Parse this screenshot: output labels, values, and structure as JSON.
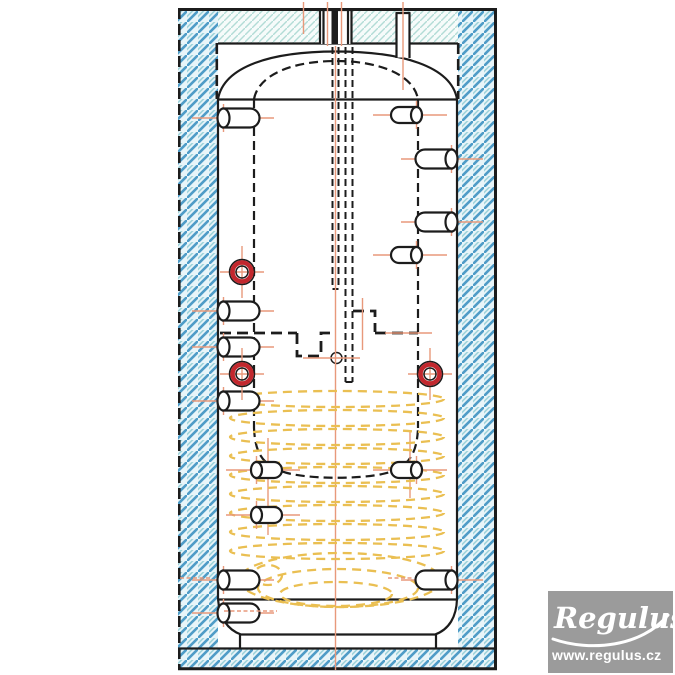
{
  "logo": {
    "brand": "Regulus",
    "url": "www.regulus.cz"
  },
  "colors": {
    "ink": "#1c1c1c",
    "centerline_orange": "#e8997b",
    "coil_yellow": "#eabf52",
    "marker_red": "#c2272d",
    "hatch_bg": "#e8f5f9",
    "hatch_stripe": "#4f9cc7",
    "hatch_stripe_light": "#9fd3da",
    "hatch_fine_bg": "#f6fbfa",
    "hatch_fine_stripe": "#b2dcd6",
    "logo_bg": "#9b9b9b",
    "logo_text": "#ffffff"
  },
  "drawing": {
    "ports": [
      {
        "id": "top-left",
        "side": "left",
        "x": 218,
        "y": 118
      },
      {
        "id": "left-upper",
        "side": "left",
        "x": 218,
        "y": 311
      },
      {
        "id": "left-middle",
        "side": "left",
        "x": 218,
        "y": 347
      },
      {
        "id": "left-lower",
        "side": "left",
        "x": 218,
        "y": 401
      },
      {
        "id": "left-bottom",
        "side": "left",
        "x": 218,
        "y": 580
      },
      {
        "id": "left-drain",
        "side": "left",
        "x": 218,
        "y": 613
      },
      {
        "id": "coil-left-upper",
        "side": "inner-left",
        "x": 252,
        "y": 470
      },
      {
        "id": "coil-left-lower",
        "side": "inner-left",
        "x": 252,
        "y": 515
      },
      {
        "id": "right-top-inner",
        "side": "inner-right",
        "x": 421,
        "y": 115
      },
      {
        "id": "right-upper",
        "side": "right",
        "x": 457,
        "y": 159
      },
      {
        "id": "right-middle",
        "side": "right",
        "x": 457,
        "y": 222
      },
      {
        "id": "right-inner-lower",
        "side": "inner-right",
        "x": 421,
        "y": 255
      },
      {
        "id": "coil-right",
        "side": "inner-right",
        "x": 421,
        "y": 470
      },
      {
        "id": "right-bottom",
        "side": "right",
        "x": 457,
        "y": 580
      }
    ],
    "sensor_markers": [
      {
        "x": 242,
        "y": 272
      },
      {
        "x": 242,
        "y": 374
      },
      {
        "x": 430,
        "y": 374
      }
    ],
    "coil": {
      "turns": {
        "count": 9,
        "cx": 337,
        "rx": 107,
        "ry": 8,
        "y_start": 399,
        "y_step": 19
      },
      "bottom_loops": [
        {
          "cx": 340,
          "cy": 580,
          "rx": 101,
          "ry": 27
        },
        {
          "cx": 338,
          "cy": 588,
          "rx": 80,
          "ry": 19
        },
        {
          "cx": 336,
          "cy": 594,
          "rx": 56,
          "ry": 12
        },
        {
          "cx": 268,
          "cy": 575,
          "rx": 14,
          "ry": 10
        }
      ]
    },
    "aux_marks": [
      {
        "x1": 180,
        "y": 578,
        "x2": 212
      },
      {
        "x1": 388,
        "y": 578,
        "x2": 414
      },
      {
        "x1": 224,
        "y": 611,
        "x2": 277
      }
    ]
  }
}
